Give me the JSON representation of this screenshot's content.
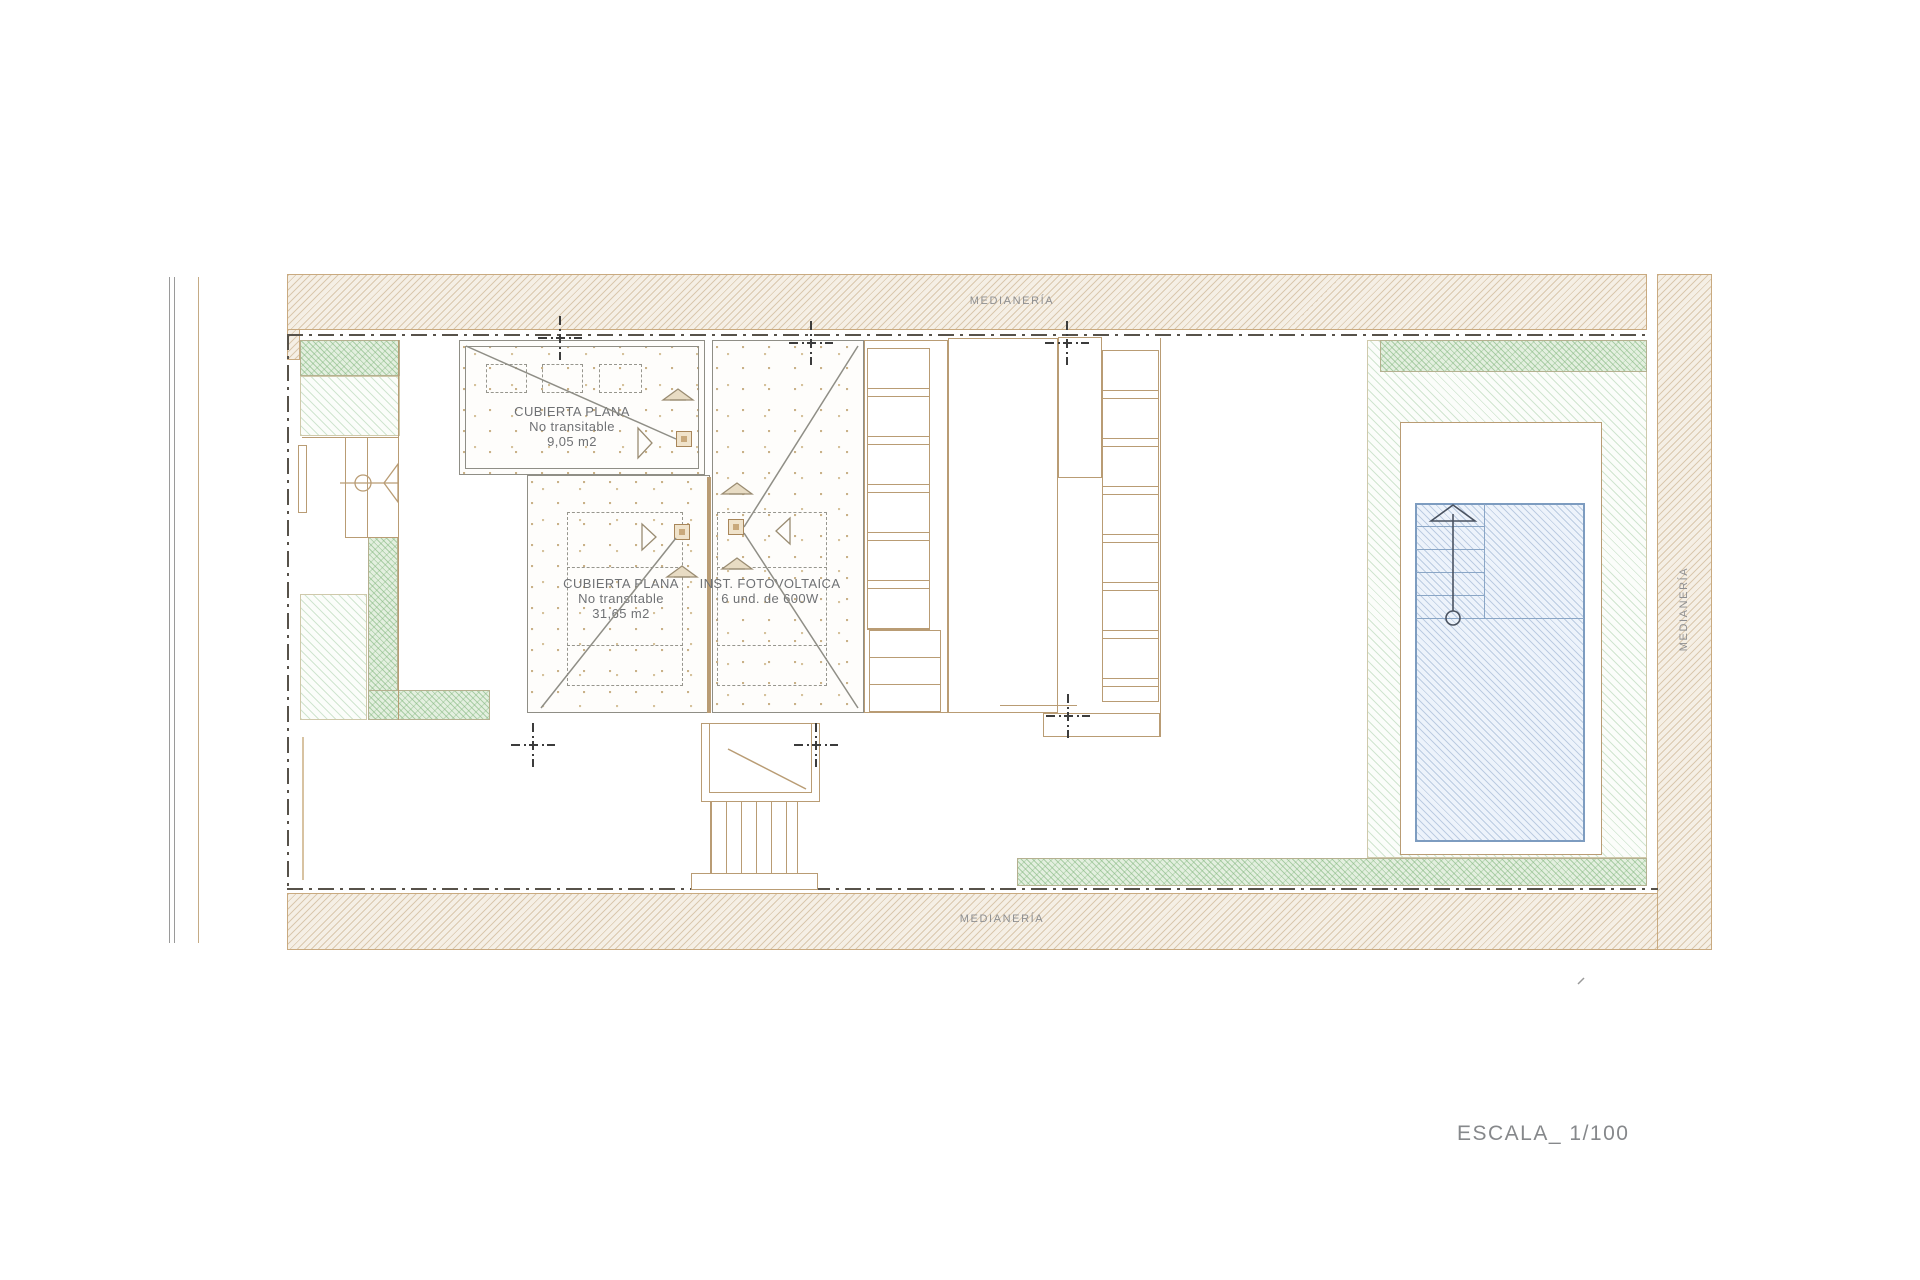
{
  "drawing": {
    "type": "architectural-roof-plan",
    "scale_label": "ESCALA_ 1/100",
    "labels": {
      "medianeria": "MEDIANERÍA"
    },
    "roofs": {
      "small": {
        "line1": "CUBIERTA PLANA",
        "line2": "No transitable",
        "line3": "9,05 m2"
      },
      "large": {
        "line1": "CUBIERTA PLANA",
        "line2": "No transitable",
        "line3": "31,65 m2"
      }
    },
    "solar": {
      "line1": "INST. FOTOVOLTAICA",
      "line2": "6 und.  de 600W"
    },
    "colors": {
      "wall_tan": "#b99c74",
      "band_hatch": "#c9aa80",
      "garden_green": "#7cb377",
      "pool_blue": "#7d9cc0",
      "boundary_dash": "#57524a",
      "text_gray": "#6f7174"
    }
  }
}
